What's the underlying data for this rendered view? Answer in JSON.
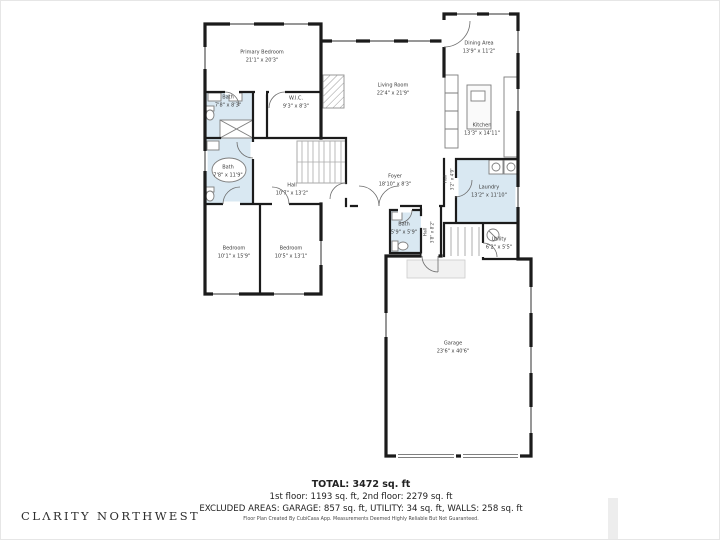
{
  "rooms": [
    {
      "id": "primary-bedroom",
      "name": "Primary Bedroom",
      "dims": "21'1\" x 20'3\""
    },
    {
      "id": "bath-upper",
      "name": "Bath",
      "dims": "7'8\" x 8'3\""
    },
    {
      "id": "wic",
      "name": "W.I.C.",
      "dims": "9'3\" x 8'3\""
    },
    {
      "id": "bath-primary",
      "name": "Bath",
      "dims": "7'8\" x 11'9\""
    },
    {
      "id": "hall-main",
      "name": "Hall",
      "dims": "10'7\" x 13'2\""
    },
    {
      "id": "foyer",
      "name": "Foyer",
      "dims": "18'10\" x 8'3\""
    },
    {
      "id": "living-room",
      "name": "Living Room",
      "dims": "22'4\" x 21'9\""
    },
    {
      "id": "dining-area",
      "name": "Dining Area",
      "dims": "13'9\" x 11'2\""
    },
    {
      "id": "kitchen",
      "name": "Kitchen",
      "dims": "13'3\" x 14'11\""
    },
    {
      "id": "hall-kitchen",
      "name": "Hall",
      "dims": "3'2\" x 4'9\""
    },
    {
      "id": "laundry",
      "name": "Laundry",
      "dims": "13'2\" x 11'10\""
    },
    {
      "id": "utility",
      "name": "Utility",
      "dims": "6'2\" x 5'5\""
    },
    {
      "id": "bath-half",
      "name": "Bath",
      "dims": "5'9\" x 5'9\""
    },
    {
      "id": "hall-garage",
      "name": "Hall",
      "dims": "3'8\" x 8'2\""
    },
    {
      "id": "bedroom-1",
      "name": "Bedroom",
      "dims": "10'1\" x 15'9\""
    },
    {
      "id": "bedroom-2",
      "name": "Bedroom",
      "dims": "10'5\" x 13'1\""
    },
    {
      "id": "garage",
      "name": "Garage",
      "dims": "23'6\" x 40'6\""
    }
  ],
  "summary": {
    "total": "TOTAL: 3472 sq. ft",
    "floors": "1st floor: 1193 sq. ft, 2nd floor: 2279 sq. ft",
    "excluded": "EXCLUDED AREAS: GARAGE: 857 sq. ft, UTILITY: 34 sq. ft, WALLS: 258 sq. ft",
    "disclaimer": "Floor Plan Created By CubiCasa App. Measurements Deemed Highly Reliable But Not Guaranteed."
  },
  "branding": {
    "logo": "CLΛRITY  NORTHWEST"
  },
  "colors": {
    "wall": "#1b1b1b",
    "wet_room_fill": "#d9e8f2",
    "label_text": "#3b3b3b"
  }
}
